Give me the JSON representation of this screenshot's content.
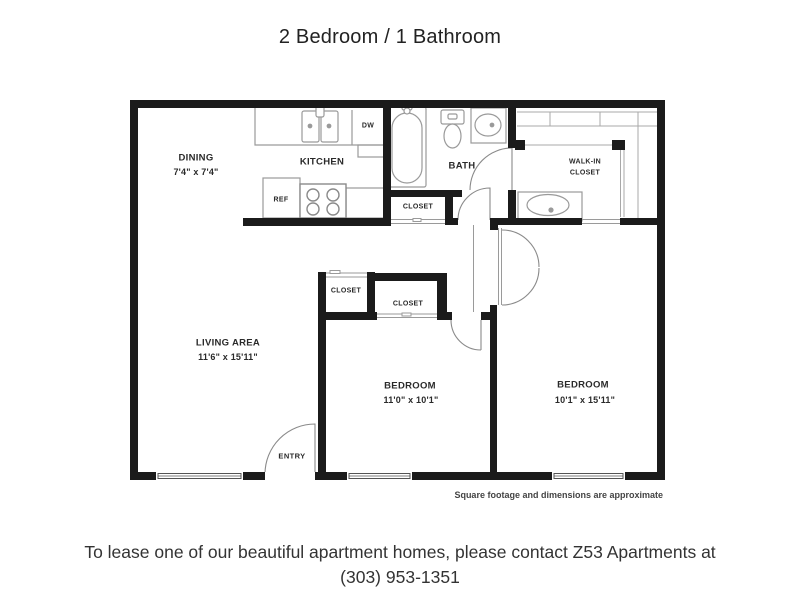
{
  "title": "2 Bedroom / 1 Bathroom",
  "plan": {
    "rooms": {
      "dining": {
        "name": "DINING",
        "dims": "7'4\" x 7'4\""
      },
      "kitchen": {
        "name": "KITCHEN"
      },
      "bath": {
        "name": "BATH"
      },
      "walkin": {
        "line1": "WALK-IN",
        "line2": "CLOSET"
      },
      "living": {
        "name": "LIVING AREA",
        "dims": "11'6\" x 15'11\""
      },
      "bedroom1": {
        "name": "BEDROOM",
        "dims": "11'0\" x 10'1\""
      },
      "bedroom2": {
        "name": "BEDROOM",
        "dims": "10'1\" x 15'11\""
      }
    },
    "fixtures": {
      "ref": "REF",
      "dw": "DW"
    },
    "closet_label": "CLOSET",
    "entry_label": "ENTRY",
    "footnote": "Square footage and dimensions are approximate"
  },
  "caption": {
    "line1": "To lease one of our beautiful apartment homes, please contact Z53 Apartments at",
    "line2": "(303) 953-1351"
  },
  "colors": {
    "wall": "#1b1b1b",
    "fixture": "#999999",
    "text": "#2a2a2a"
  }
}
